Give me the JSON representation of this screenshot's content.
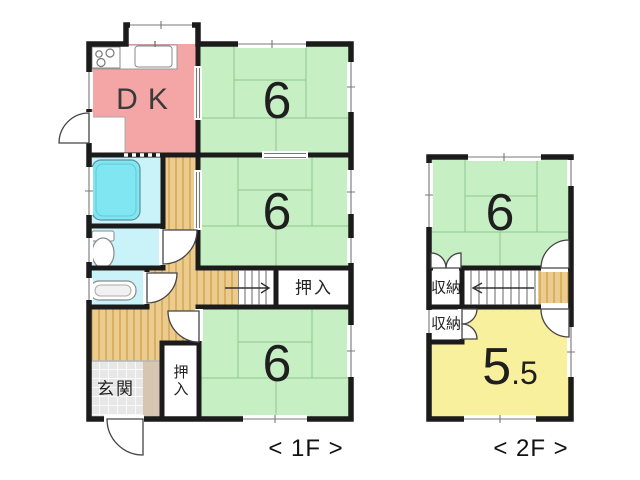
{
  "plan": {
    "type": "floor-plan",
    "floors": [
      "1F",
      "2F"
    ]
  },
  "colors": {
    "wall": "#1b1b1b",
    "dk_pink": "#F4A5A5",
    "tatami_green": "#C6EFC4",
    "bath_cyan": "#C9F3F8",
    "tub_cyan": "#7FE6F2",
    "room_yellow": "#F8F09C",
    "step_beige": "#D6C6B1"
  },
  "floor1": {
    "caption": "< 1F >",
    "rooms": {
      "dk": {
        "label": "DK"
      },
      "tatami_top": {
        "label": "6"
      },
      "tatami_mid": {
        "label": "6"
      },
      "tatami_bottom": {
        "label": "6"
      },
      "oshiire_stairs": {
        "label": "押入"
      },
      "oshiire_entrance": {
        "label": "押入"
      },
      "genkan": {
        "label": "玄関"
      }
    }
  },
  "floor2": {
    "caption": "< 2F >",
    "rooms": {
      "tatami": {
        "label": "6"
      },
      "storage_upper": {
        "label": "収納"
      },
      "storage_lower": {
        "label": "収納"
      },
      "western": {
        "label_main": "5",
        "label_sub": ".5"
      }
    }
  }
}
